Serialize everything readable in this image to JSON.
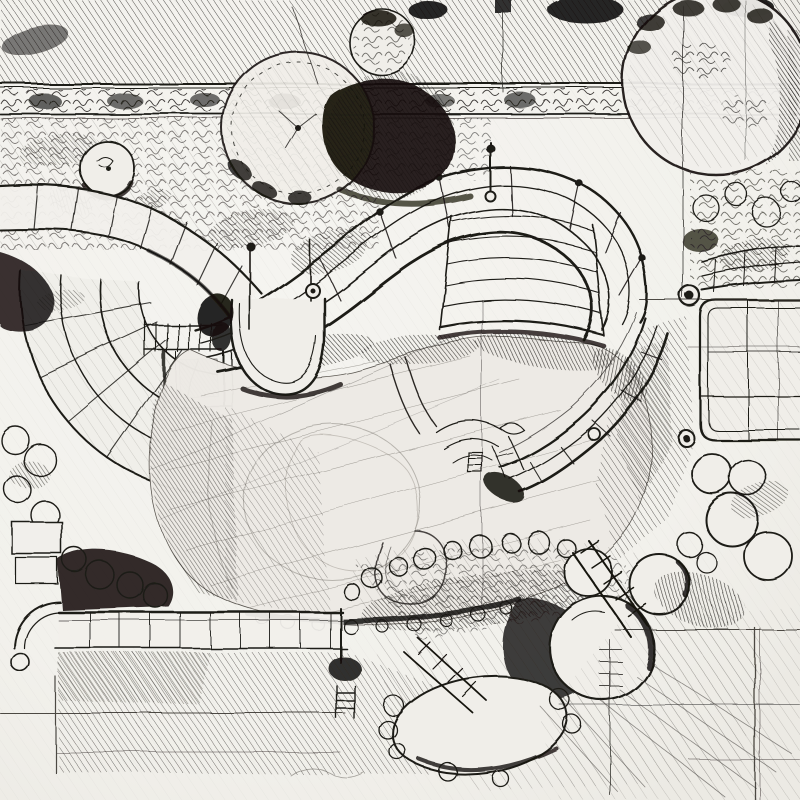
{
  "canvas": {
    "width": 800,
    "height": 800
  },
  "palette": {
    "paper": "#f3f2ee",
    "paper_light": "#f0eee9",
    "ink": "#1c1a17",
    "ink_dark": "#0f0d0b",
    "hatch_light": "#5c5954",
    "wash": "#edeae5"
  },
  "scene": {
    "medium": "pen-and-ink freehand sketch",
    "subject": "landscape garden plan, top-down view",
    "description": "Hand-drawn pen and ink landscape architecture plan sketch: a hatched hedge band and scribbled tree canopies along the top, a winding jointed path and radial stone terrace at left, a concentric amphitheater stair band wrapping a large organic pond at center, a small water channel and swirl feature, a gridded patio deck at right, boulder rock garden and dark shrub masses across the bottom, all overlaid with thin construction lines.",
    "elements": [
      "hedge-band",
      "shrub-row",
      "tree-canopy-scalloped",
      "tree-canopy-dark",
      "tree-canopy-small",
      "tree-canopy-top-right",
      "winding-path",
      "radial-terrace",
      "steps-ladder",
      "amphitheater-stair-band",
      "stair-fan-steps",
      "promontory-bulge",
      "pond",
      "water-channel",
      "swirl-feature",
      "loop-mark",
      "right-wall-band",
      "patio-deck",
      "rock-garden",
      "boulders",
      "bottom-walkway",
      "corner-steps",
      "shrub-mass-dark",
      "construction-lines",
      "hatching-fields"
    ]
  }
}
